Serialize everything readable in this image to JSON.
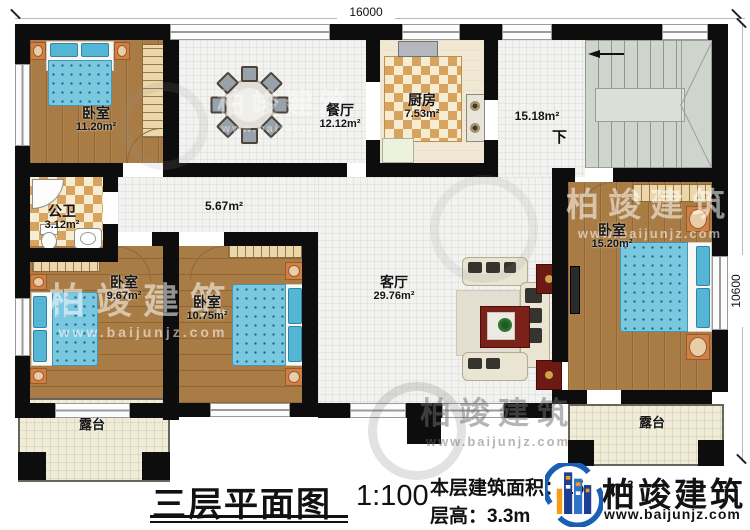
{
  "plan": {
    "dimensions": {
      "width_label": "16000",
      "height_label": "10600"
    },
    "rooms": [
      {
        "name": "卧室",
        "area": "11.20m²"
      },
      {
        "name": "餐厅",
        "area": "12.12m²"
      },
      {
        "name": "厨房",
        "area": "7.53m²"
      },
      {
        "name": "",
        "area": "15.18m²"
      },
      {
        "name": "",
        "area": "5.67m²"
      },
      {
        "name": "公卫",
        "area": "3.12m²"
      },
      {
        "name": "卧室",
        "area": "9.67m²"
      },
      {
        "name": "卧室",
        "area": "10.75m²"
      },
      {
        "name": "卧室",
        "area": "15.20m²"
      },
      {
        "name": "客厅",
        "area": "29.76m²"
      },
      {
        "name": "露台",
        "area": ""
      },
      {
        "name": "露台",
        "area": ""
      }
    ],
    "stairs": {
      "down_label": "下"
    }
  },
  "watermark": {
    "name": "柏竣建筑",
    "url": "www.baijunjz.com"
  },
  "footer": {
    "title": "三层平面图",
    "scale": "1:100",
    "area_prefix": "本层建筑面积：15",
    "area_unit": "m²",
    "floor_height": "层高：3.3m",
    "brand_name": "柏竣建筑",
    "brand_url": "www.baijunjz.com"
  },
  "colors": {
    "wall": "#0d0d0d",
    "wood_floor": "#a87c44",
    "tile_floor": "#f2f2f0",
    "bed_blue": "#7ac7e0",
    "logo_blue": "#1c4f9e",
    "logo_orange": "#f59d1a"
  }
}
